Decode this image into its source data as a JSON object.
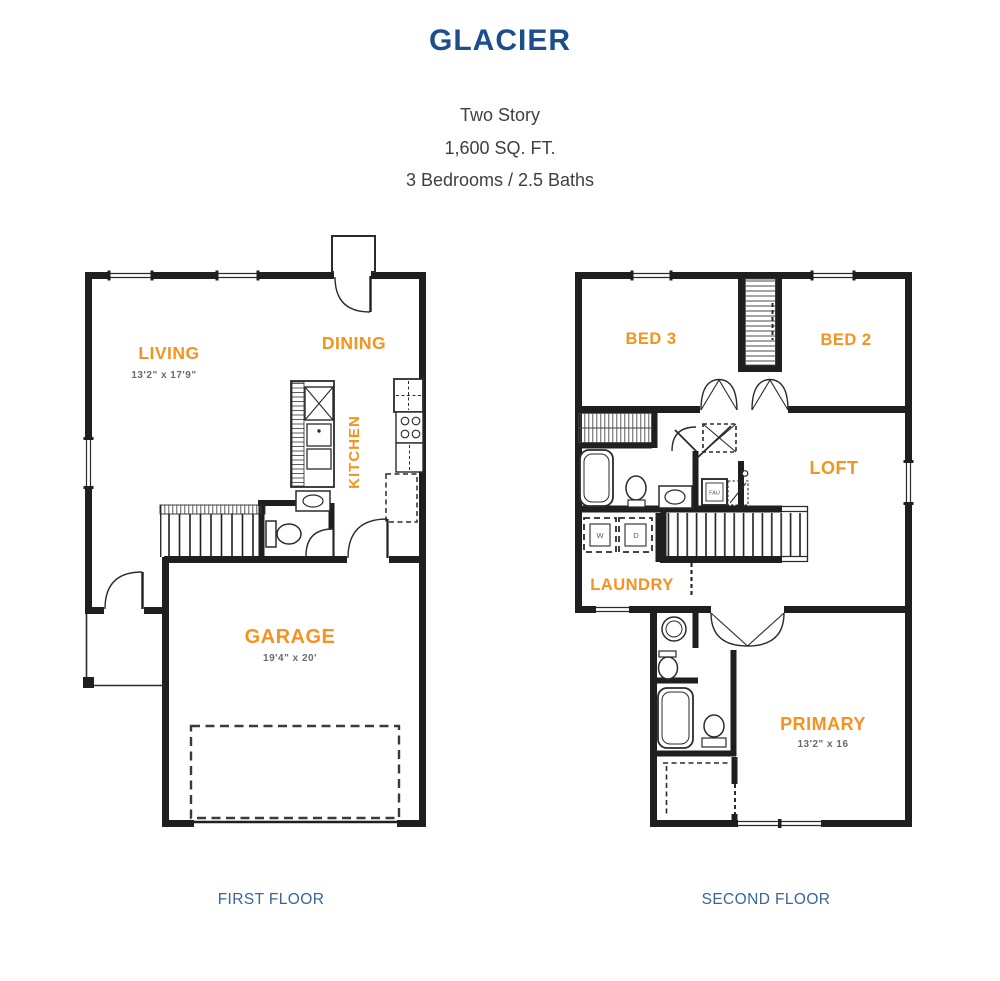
{
  "header": {
    "title": "GLACIER",
    "subtitle": [
      "Two Story",
      "1,600 SQ. FT.",
      "3 Bedrooms / 2.5 Baths"
    ]
  },
  "first_floor": {
    "caption": "FIRST FLOOR",
    "living": {
      "label": "LIVING",
      "dims": "13'2\" x 17'9\""
    },
    "dining": {
      "label": "DINING"
    },
    "kitchen": {
      "label": "KITCHEN"
    },
    "garage": {
      "label": "GARAGE",
      "dims": "19'4\" x 20'"
    }
  },
  "second_floor": {
    "caption": "SECOND FLOOR",
    "bed3": {
      "label": "BED 3"
    },
    "bed2": {
      "label": "BED 2"
    },
    "loft": {
      "label": "LOFT"
    },
    "laundry": {
      "label": "LAUNDRY",
      "washer_label": "W",
      "dryer_label": "D"
    },
    "primary": {
      "label": "PRIMARY",
      "dims": "13'2\" x 16"
    },
    "fau": {
      "label": "FAU"
    }
  },
  "colors": {
    "accent_orange": "#f6921e",
    "title_blue": "#1c4e8c",
    "caption_blue": "#3a659b",
    "wall_black": "#1f1f1f",
    "dim_gray": "#6a6a6a"
  }
}
